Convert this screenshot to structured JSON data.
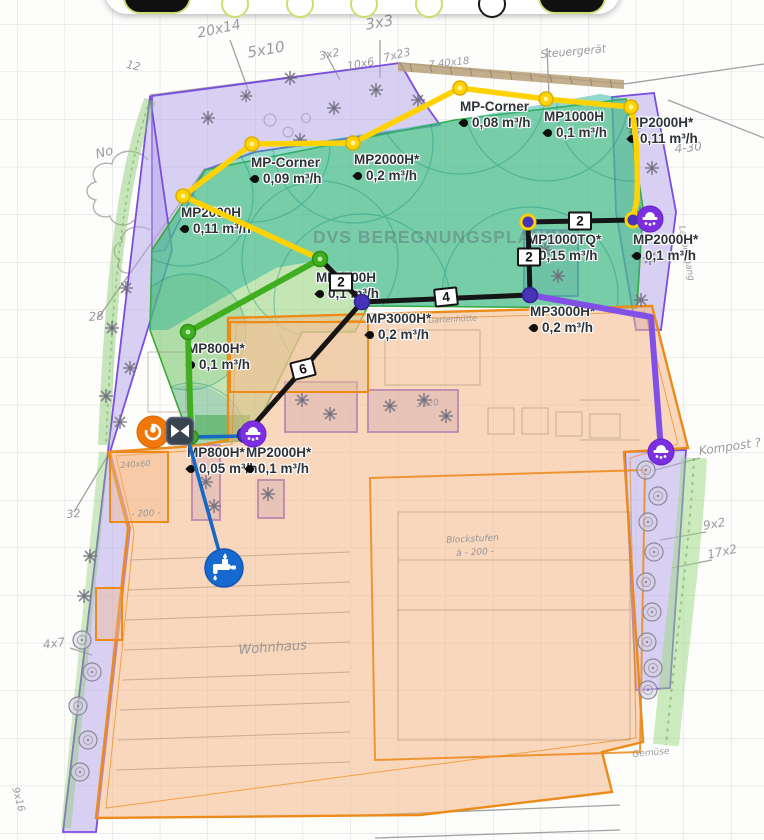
{
  "app": {
    "watermark": "DVS BEREGNUNGSPLANER"
  },
  "toolbar": {
    "icons": [
      "menu-pill",
      "tool-circle-1",
      "tool-circle-2",
      "tool-circle-3",
      "tool-circle-4",
      "tool-circle-dark",
      "menu-pill-2"
    ]
  },
  "sprinklers": [
    {
      "name": "MP-Corner",
      "flow": "0,08 m³/h"
    },
    {
      "name": "MP1000H",
      "flow": "0,1 m³/h"
    },
    {
      "name": "MP2000H*",
      "flow": "0,11 m³/h"
    },
    {
      "name": "MP-Corner",
      "flow": "0,09 m³/h"
    },
    {
      "name": "MP2000H*",
      "flow": "0,2 m³/h"
    },
    {
      "name": "MP2000H",
      "flow": "0,11 m³/h"
    },
    {
      "name": "MP1000TQ*",
      "flow": "0,15 m³/h"
    },
    {
      "name": "MP2000H*",
      "flow": "0,1 m³/h"
    },
    {
      "name": "MP1000H",
      "flow": "0,1 m³/h"
    },
    {
      "name": "MP3000H*",
      "flow": "0,2 m³/h"
    },
    {
      "name": "MP3000H*",
      "flow": "0,2 m³/h"
    },
    {
      "name": "MP800H*",
      "flow": "0,1 m³/h"
    },
    {
      "name": "MP800H*",
      "flow": "0,05 m³/h"
    },
    {
      "name": "MP2000H*",
      "flow": "0,1 m³/h"
    }
  ],
  "pipe_labels": [
    {
      "value": "2"
    },
    {
      "value": "4"
    },
    {
      "value": "2"
    },
    {
      "value": "2"
    },
    {
      "value": "6"
    }
  ],
  "annotations": [
    "20x14",
    "5x10",
    "3x2",
    "3x3",
    "10x6",
    "7x23",
    "7 40x18",
    "Steuergerät",
    "4-30",
    "No",
    "12",
    "28",
    "32",
    "240x60",
    "- 200 -",
    "4x7",
    "Wohnhaus",
    "Blockstufen",
    "à - 200 -",
    "Kompost ?",
    "9x2",
    "17x2",
    "Laubengang",
    "Gartenhütte",
    "3x20",
    "Gemüse",
    "9x16"
  ],
  "icons": {
    "controller": "irrigation-controller",
    "valve": "zone-valve",
    "tap": "water-tap",
    "sprinkler_head": "sprinkler-head"
  },
  "colors": {
    "pipe_yellow": "#ffd200",
    "pipe_green": "#3fae1f",
    "pipe_black": "#151515",
    "pipe_blue": "#1668c7",
    "pipe_purple": "#8150e6",
    "zone_teal": "#2ab39b",
    "zone_lawn": "#8ccf6e",
    "bed_purple": "#b7a6ea",
    "house_orange": "#f4b887",
    "outline_orange": "#ec8a1a",
    "outline_purple": "#7a4ee0",
    "node_indigo": "#4633b8"
  }
}
